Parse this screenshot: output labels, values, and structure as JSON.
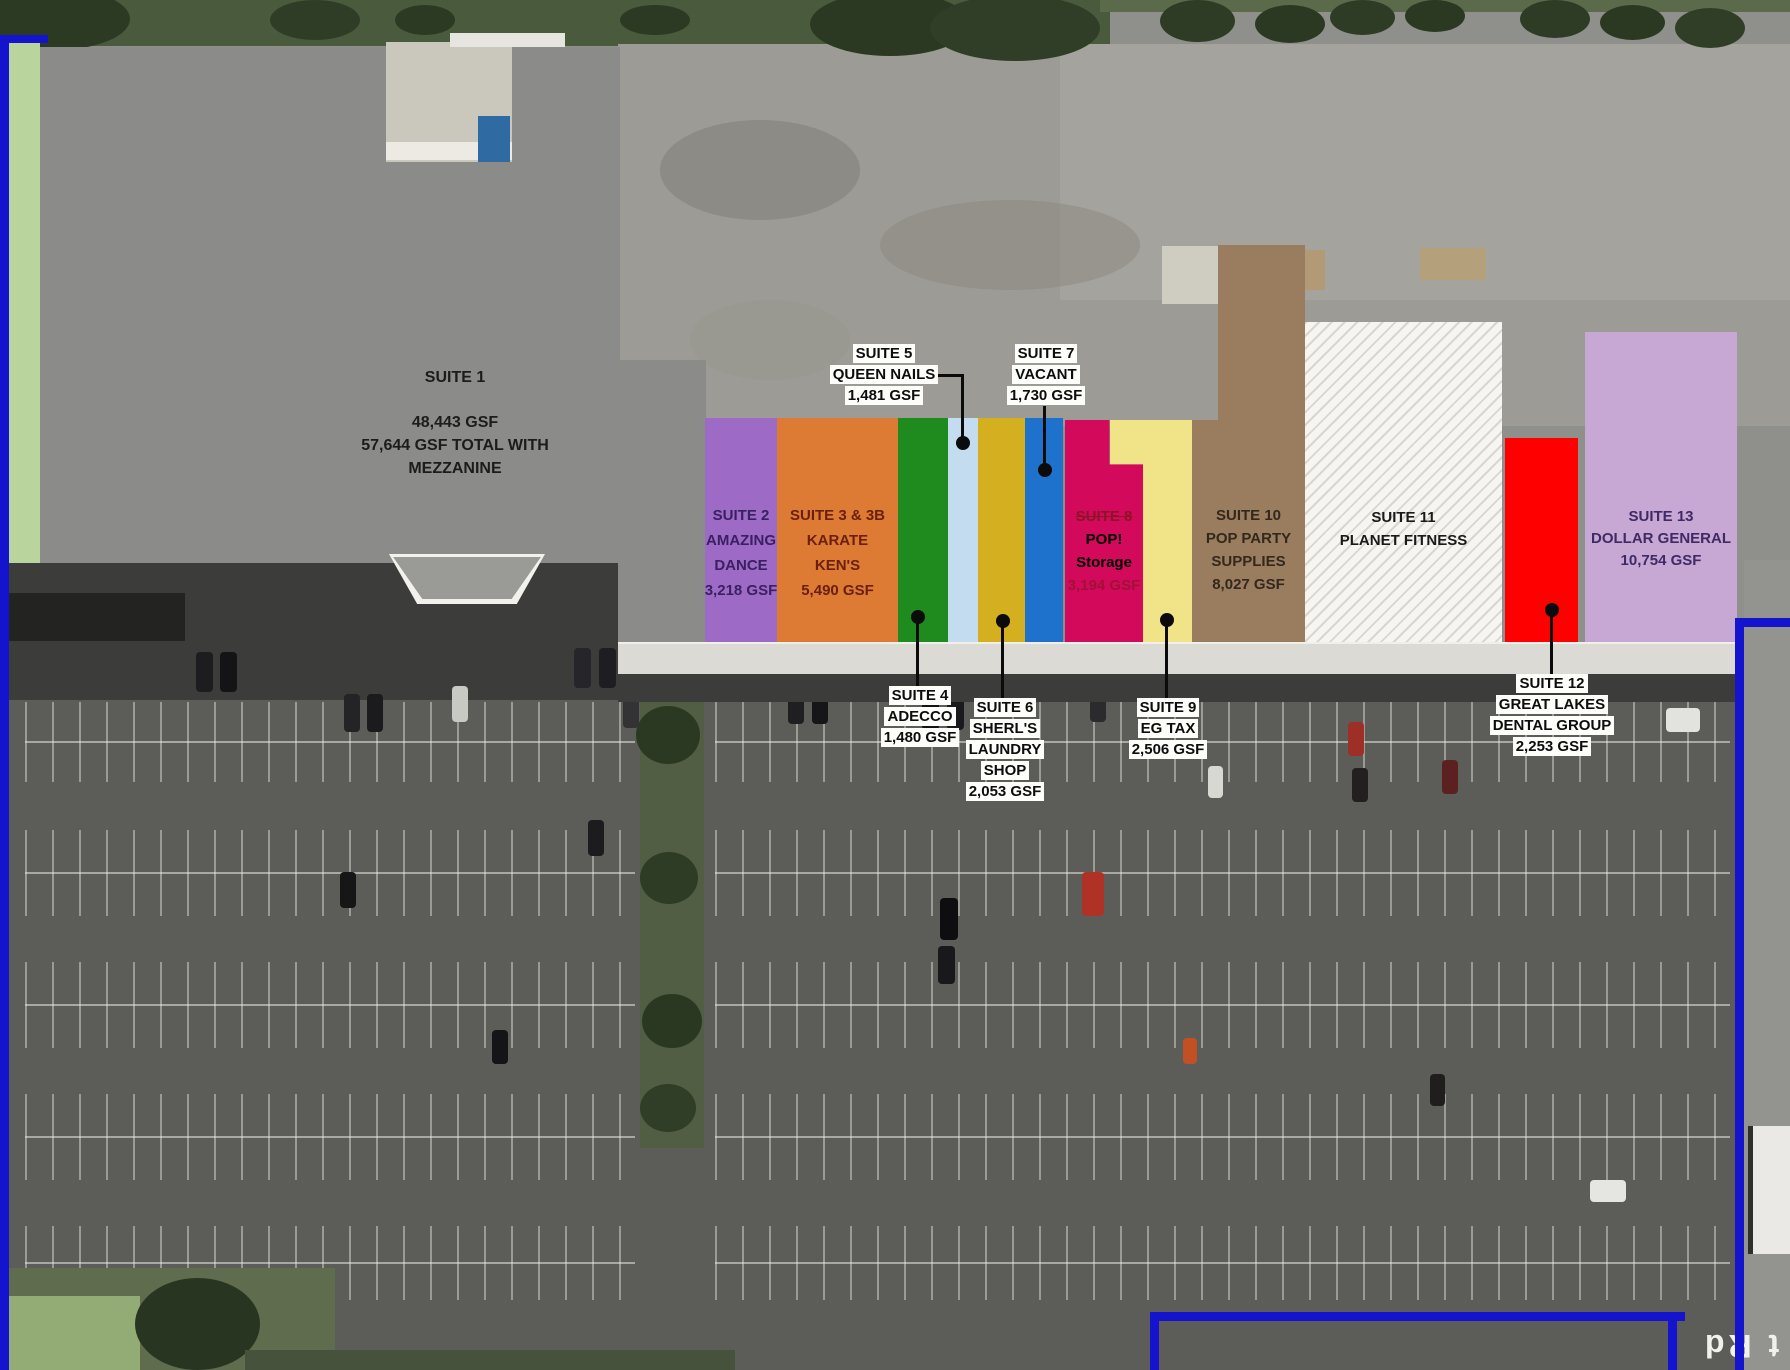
{
  "suites": {
    "s1b": {
      "lines": [
        "SUITE 1B",
        "VACANT",
        "30,442 GSF",
        "32,740 GSF TOTAL WITH",
        "SECOND FLOOR"
      ]
    },
    "s1": {
      "lines": [
        "SUITE 1",
        "48,443 GSF",
        "57,644 GSF TOTAL WITH",
        "MEZZANINE"
      ]
    },
    "s2": {
      "lines": [
        "SUITE 2",
        "AMAZING",
        "DANCE",
        "3,218 GSF"
      ]
    },
    "s3": {
      "lines": [
        "SUITE 3 & 3B",
        "KARATE",
        "KEN'S",
        "5,490 GSF"
      ]
    },
    "s4": {
      "lines": [
        "SUITE 4",
        "ADECCO",
        "1,480 GSF"
      ]
    },
    "s5": {
      "lines": [
        "SUITE 5",
        "QUEEN NAILS",
        "1,481 GSF"
      ]
    },
    "s6": {
      "lines": [
        "SUITE 6",
        "SHERL'S",
        "LAUNDRY",
        "SHOP",
        "2,053 GSF"
      ]
    },
    "s7": {
      "lines": [
        "SUITE 7",
        "VACANT",
        "1,730 GSF"
      ]
    },
    "s8": {
      "lines": [
        "SUITE 8",
        "POP!",
        "Storage",
        "3,194 GSF"
      ]
    },
    "s9": {
      "lines": [
        "SUITE 9",
        "EG TAX",
        "2,506 GSF"
      ]
    },
    "s10": {
      "lines": [
        "SUITE 10",
        "POP PARTY",
        "SUPPLIES",
        "8,027 GSF"
      ]
    },
    "s11": {
      "lines": [
        "SUITE 11",
        "PLANET FITNESS"
      ]
    },
    "s12": {
      "lines": [
        "SUITE 12",
        "GREAT LAKES",
        "DENTAL GROUP",
        "2,253 GSF"
      ]
    },
    "s13": {
      "lines": [
        "SUITE 13",
        "DOLLAR GENERAL",
        "10,754 GSF"
      ]
    }
  },
  "road_label": "t Rd",
  "colors": {
    "suite1b": "#b9d49c",
    "suite1": "#8b8b89",
    "suite2": "#9d6bc5",
    "suite3": "#dd7a33",
    "suite4": "#1f8b1f",
    "suite5": "#c3dcf0",
    "suite6": "#d4af1f",
    "suite7": "#1e72cc",
    "suite8": "#d30a5c",
    "suite9": "#f1e387",
    "suite10": "#9a7d5e",
    "suite11": "#f6f5f2",
    "suite12": "#fe0000",
    "suite13": "#c7a7d3",
    "property_line": "#1414cf"
  }
}
